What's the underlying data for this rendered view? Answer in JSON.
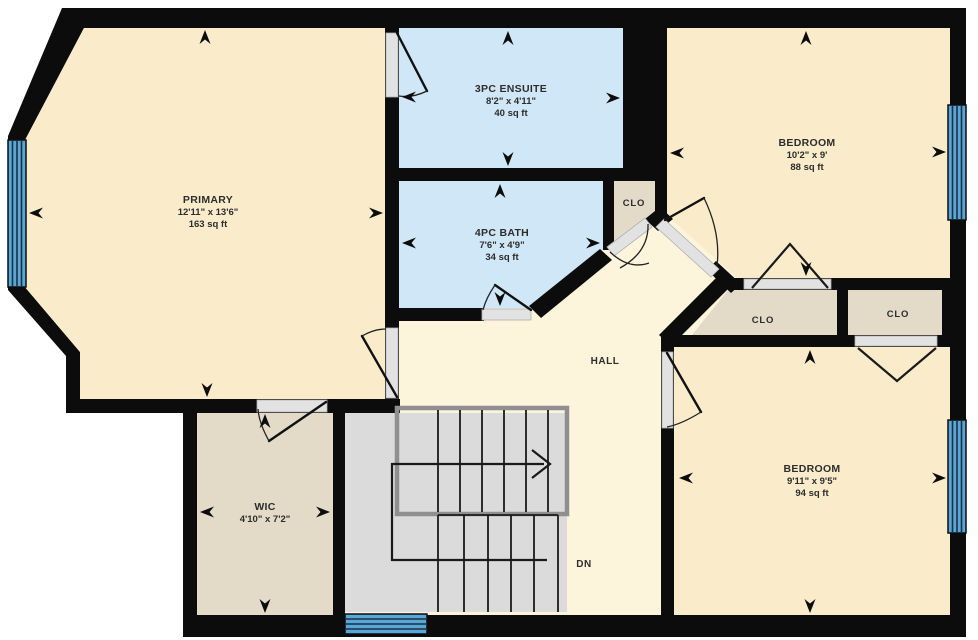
{
  "plan": {
    "type": "floor-plan",
    "rooms": {
      "primary": {
        "name": "PRIMARY",
        "dims": "12'11\" x 13'6\"",
        "area": "163 sq ft"
      },
      "ensuite": {
        "name": "3PC ENSUITE",
        "dims": "8'2\" x 4'11\"",
        "area": "40 sq ft"
      },
      "bath": {
        "name": "4PC BATH",
        "dims": "7'6\" x 4'9\"",
        "area": "34 sq ft"
      },
      "bedroom1": {
        "name": "BEDROOM",
        "dims": "10'2\" x 9'",
        "area": "88 sq ft"
      },
      "bedroom2": {
        "name": "BEDROOM",
        "dims": "9'11\" x 9'5\"",
        "area": "94 sq ft"
      },
      "wic": {
        "name": "WIC",
        "dims": "4'10\" x 7'2\""
      },
      "closet1": {
        "name": "CLO"
      },
      "closet2": {
        "name": "CLO"
      },
      "closet3": {
        "name": "CLO"
      },
      "hall": {
        "name": "HALL"
      },
      "stairs": {
        "down_label": "DN"
      }
    },
    "colors": {
      "outside": "#ffffff",
      "wall": "#0c0c0c",
      "room_floor": "#faeccb",
      "hall_floor": "#fdf4dc",
      "bath_floor": "#cfe7f6",
      "closet_floor": "#e3dac8",
      "stair_floor": "#dbdbdb",
      "window": "#57a7d8",
      "door_opening": "#e2e2e2",
      "text": "#2d2d2d"
    }
  }
}
